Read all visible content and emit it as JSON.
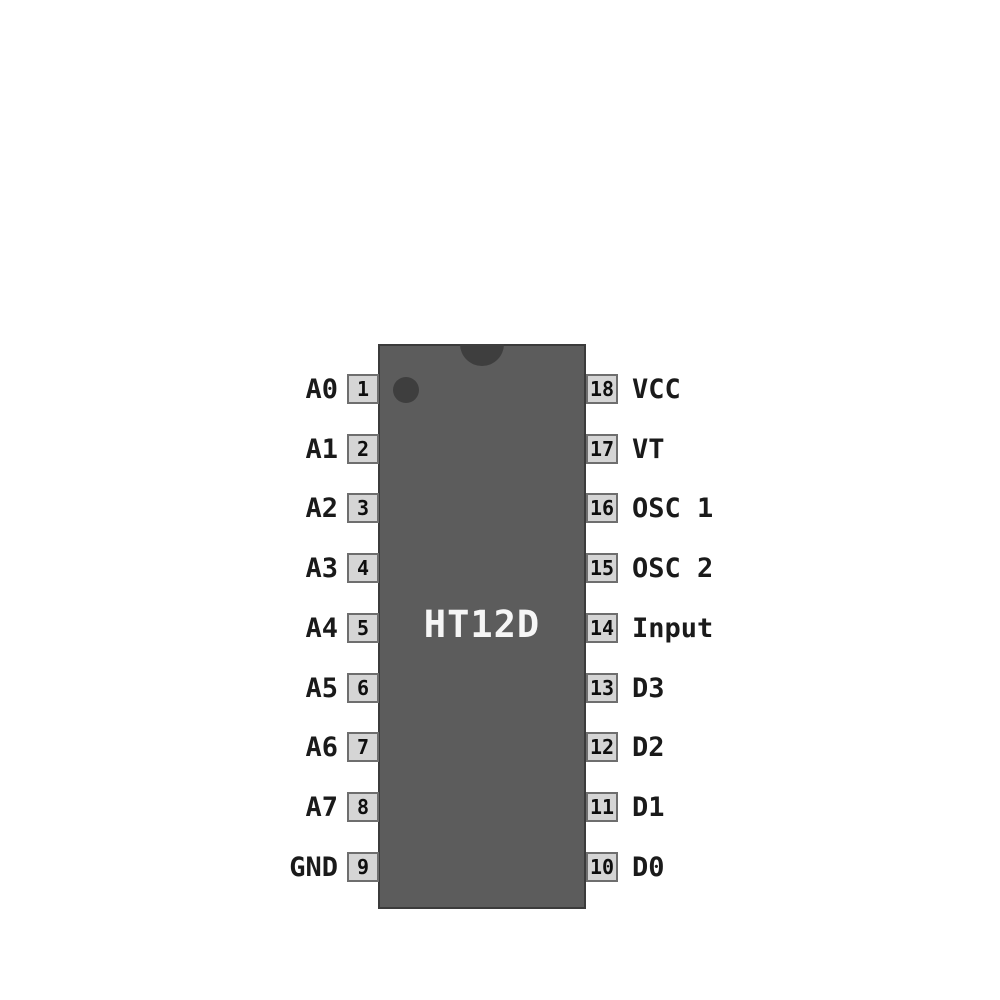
{
  "chip": {
    "name": "HT12D"
  },
  "pins": {
    "left": [
      {
        "number": "1",
        "label": "A0"
      },
      {
        "number": "2",
        "label": "A1"
      },
      {
        "number": "3",
        "label": "A2"
      },
      {
        "number": "4",
        "label": "A3"
      },
      {
        "number": "5",
        "label": "A4"
      },
      {
        "number": "6",
        "label": "A5"
      },
      {
        "number": "7",
        "label": "A6"
      },
      {
        "number": "8",
        "label": "A7"
      },
      {
        "number": "9",
        "label": "GND"
      }
    ],
    "right": [
      {
        "number": "18",
        "label": "VCC"
      },
      {
        "number": "17",
        "label": "VT"
      },
      {
        "number": "16",
        "label": "OSC 1"
      },
      {
        "number": "15",
        "label": "OSC 2"
      },
      {
        "number": "14",
        "label": "Input"
      },
      {
        "number": "13",
        "label": "D3"
      },
      {
        "number": "12",
        "label": "D2"
      },
      {
        "number": "11",
        "label": "D1"
      },
      {
        "number": "10",
        "label": "D0"
      }
    ]
  },
  "colors": {
    "background": "#ffffff",
    "ic_body": "#5c5c5c",
    "notch_and_dot": "#3e3e3e",
    "pin_box_fill": "#d5d5d5",
    "pin_box_border": "#6e6e6e",
    "label_text": "#1a1a1a",
    "chip_name_text": "#f6f6f6"
  }
}
